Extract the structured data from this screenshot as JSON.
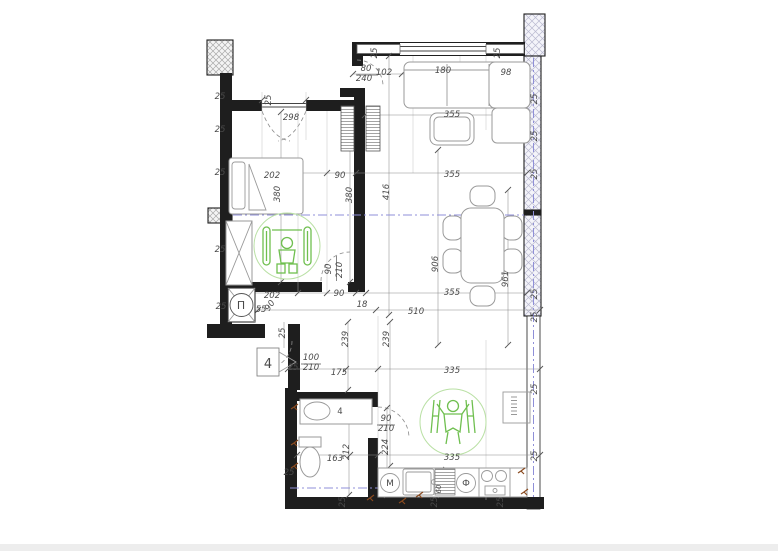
{
  "document": {
    "type": "architectural apartment floor plan",
    "rooms_implied": [
      "bedroom",
      "living-dining room",
      "bathroom",
      "kitchen",
      "entry hall"
    ],
    "symbols": {
      "shaft_letter": "П",
      "washing_machine_letter": "M",
      "dishwasher_letter": "Ф",
      "entry_door_number": "4"
    }
  },
  "colors": {
    "wall": "#1e1e1e",
    "furn": "#9a9a9a",
    "green": "#6fbf4f",
    "greenLight": "#b9e0a4",
    "lavender": "#8f8fd8",
    "brown": "#8a4a1f",
    "dimText": "#4a4a4a",
    "hatch": "#b9b9d0",
    "band": "#ededed"
  },
  "labels": [
    {
      "t": "80",
      "x": 366,
      "y": 71
    },
    {
      "t": "240",
      "x": 364,
      "y": 81
    },
    {
      "t": "102",
      "x": 384,
      "y": 75
    },
    {
      "t": "25",
      "x": 377,
      "y": 53,
      "r": -90
    },
    {
      "t": "25",
      "x": 500,
      "y": 53,
      "r": -90
    },
    {
      "t": "180",
      "x": 443,
      "y": 73
    },
    {
      "t": "98",
      "x": 506,
      "y": 75
    },
    {
      "t": "355",
      "x": 452,
      "y": 117
    },
    {
      "t": "25",
      "x": 220,
      "y": 99
    },
    {
      "t": "25",
      "x": 220,
      "y": 132
    },
    {
      "t": "25",
      "x": 220,
      "y": 175
    },
    {
      "t": "25",
      "x": 220,
      "y": 252
    },
    {
      "t": "25",
      "x": 221,
      "y": 309
    },
    {
      "t": "298",
      "x": 291,
      "y": 120
    },
    {
      "t": "25",
      "x": 271,
      "y": 100,
      "r": -90
    },
    {
      "t": "202",
      "x": 272,
      "y": 178
    },
    {
      "t": "380",
      "x": 280,
      "y": 194,
      "r": -90
    },
    {
      "t": "90",
      "x": 340,
      "y": 178
    },
    {
      "t": "380",
      "x": 352,
      "y": 195,
      "r": -90
    },
    {
      "t": "416",
      "x": 389,
      "y": 192,
      "r": -90
    },
    {
      "t": "355",
      "x": 452,
      "y": 177
    },
    {
      "t": "906",
      "x": 438,
      "y": 264,
      "r": -90
    },
    {
      "t": "961",
      "x": 508,
      "y": 279,
      "r": -90
    },
    {
      "t": "90",
      "x": 331,
      "y": 269,
      "r": -90
    },
    {
      "t": "210",
      "x": 342,
      "y": 270,
      "r": -90
    },
    {
      "t": "202",
      "x": 272,
      "y": 298
    },
    {
      "t": "90",
      "x": 339,
      "y": 296
    },
    {
      "t": "18",
      "x": 362,
      "y": 307
    },
    {
      "t": "355",
      "x": 452,
      "y": 295
    },
    {
      "t": "510",
      "x": 416,
      "y": 314
    },
    {
      "t": "55",
      "x": 261,
      "y": 312
    },
    {
      "t": "90",
      "x": 272,
      "y": 307,
      "r": -55
    },
    {
      "t": "П",
      "x": 241,
      "y": 309,
      "s": 11,
      "i": false
    },
    {
      "t": "25",
      "x": 285,
      "y": 333,
      "r": -90
    },
    {
      "t": "4",
      "x": 268,
      "y": 368,
      "s": 13,
      "i": false
    },
    {
      "t": "100",
      "x": 311,
      "y": 360
    },
    {
      "t": "210",
      "x": 311,
      "y": 370
    },
    {
      "t": "25",
      "x": 293,
      "y": 370
    },
    {
      "t": "175",
      "x": 339,
      "y": 375
    },
    {
      "t": "239",
      "x": 348,
      "y": 339,
      "r": -90
    },
    {
      "t": "239",
      "x": 389,
      "y": 339,
      "r": -90
    },
    {
      "t": "335",
      "x": 452,
      "y": 373
    },
    {
      "t": "4",
      "x": 340,
      "y": 414,
      "i": false
    },
    {
      "t": "90",
      "x": 386,
      "y": 421
    },
    {
      "t": "210",
      "x": 386,
      "y": 431
    },
    {
      "t": "224",
      "x": 388,
      "y": 447,
      "r": -90
    },
    {
      "t": "212",
      "x": 349,
      "y": 452,
      "r": -90
    },
    {
      "t": "163",
      "x": 335,
      "y": 461
    },
    {
      "t": "25",
      "x": 289,
      "y": 475
    },
    {
      "t": "335",
      "x": 452,
      "y": 460
    },
    {
      "t": "M",
      "x": 390,
      "y": 486,
      "s": 9,
      "i": false
    },
    {
      "t": "Ф",
      "x": 466,
      "y": 486,
      "s": 9,
      "i": false
    },
    {
      "t": "60",
      "x": 441,
      "y": 489,
      "r": -90,
      "s": 7
    },
    {
      "t": "25",
      "x": 345,
      "y": 502,
      "r": -90
    },
    {
      "t": "25",
      "x": 437,
      "y": 502,
      "r": -90
    },
    {
      "t": "25",
      "x": 503,
      "y": 502,
      "r": -90
    },
    {
      "t": "25",
      "x": 537,
      "y": 99,
      "r": -90
    },
    {
      "t": "25",
      "x": 537,
      "y": 136,
      "r": -90
    },
    {
      "t": "25",
      "x": 537,
      "y": 174,
      "r": -90
    },
    {
      "t": "25",
      "x": 537,
      "y": 294,
      "r": -90
    },
    {
      "t": "25",
      "x": 537,
      "y": 317,
      "r": -90
    },
    {
      "t": "25",
      "x": 537,
      "y": 389,
      "r": -90
    },
    {
      "t": "25",
      "x": 537,
      "y": 456,
      "r": -90
    }
  ]
}
